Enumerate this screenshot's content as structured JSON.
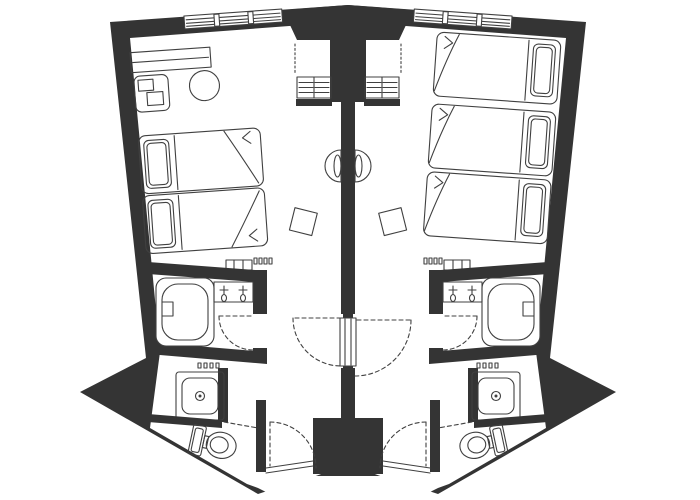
{
  "title": "Hotel guest room floor plan",
  "colors": {
    "walls": "#343434",
    "lines": "#404040",
    "floor": "#ffffff",
    "background": "#ffffff"
  },
  "plan": {
    "type": "architectural-floor-plan",
    "description": "Two mirrored fan-shaped hotel guest rooms separated by a central party wall with a connecting door, each with bathroom, shower, WC and entry vestibule at the bottom",
    "units": [
      {
        "name": "left-guest-room",
        "furniture": [
          "sofa-console",
          "armchair",
          "round-table",
          "twin-bed",
          "twin-bed",
          "luggage-rack",
          "wall-console",
          "stool"
        ],
        "bathroom_fixtures": [
          "bathtub",
          "vanity-with-two-faucets",
          "shower-tray",
          "toilet",
          "towel-hooks"
        ],
        "doors": [
          "entry-door",
          "bathroom-door",
          "wc-sliding-door",
          "connecting-door"
        ],
        "windows": 1
      },
      {
        "name": "right-guest-room",
        "furniture": [
          "single-bed",
          "single-bed",
          "single-bed",
          "luggage-rack",
          "wall-console",
          "stool"
        ],
        "bathroom_fixtures": [
          "bathtub",
          "vanity-with-two-faucets",
          "shower-tray",
          "toilet",
          "towel-hooks"
        ],
        "doors": [
          "entry-door",
          "bathroom-door",
          "wc-sliding-door",
          "connecting-door"
        ],
        "windows": 1
      }
    ],
    "shared_elements": [
      "central-dividing-wall",
      "top-service-wedge",
      "connecting-door-panel",
      "entry-block"
    ],
    "window_count": 2,
    "bed_count": 5
  }
}
